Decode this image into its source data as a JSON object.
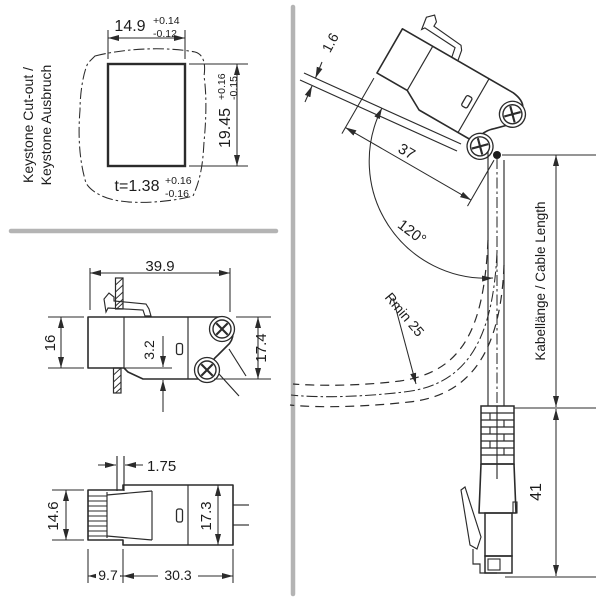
{
  "keystone_cutout": {
    "title_line1": "Keystone Cut-out /",
    "title_line2": "Keystone Ausbruch",
    "width": {
      "value": "14.9",
      "tol_plus": "+0.14",
      "tol_minus": "-0.12"
    },
    "height": {
      "value": "19.45",
      "tol_plus": "+0.16",
      "tol_minus": "-0.15"
    },
    "thickness": {
      "value": "t=1.38",
      "tol_plus": "+0.16",
      "tol_minus": "-0.16"
    }
  },
  "side_view": {
    "length": "39.9",
    "front_height": "16",
    "step": "3.2",
    "rear_height": "17.4"
  },
  "top_view": {
    "latch_width": "1.75",
    "front_height": "14.6",
    "rear_height": "17.3",
    "front_depth": "9.7",
    "rear_depth": "30.3"
  },
  "mounted_view": {
    "panel_thickness": "1.6",
    "module_length": "37",
    "cable_angle": "120°",
    "bend_radius": "Rmin 25",
    "cable_length_label": "Kabellänge / Cable Length",
    "plug_length": "41"
  },
  "colors": {
    "line": "#2b2b2b",
    "divider": "#b4b4b4",
    "background": "#ffffff"
  }
}
